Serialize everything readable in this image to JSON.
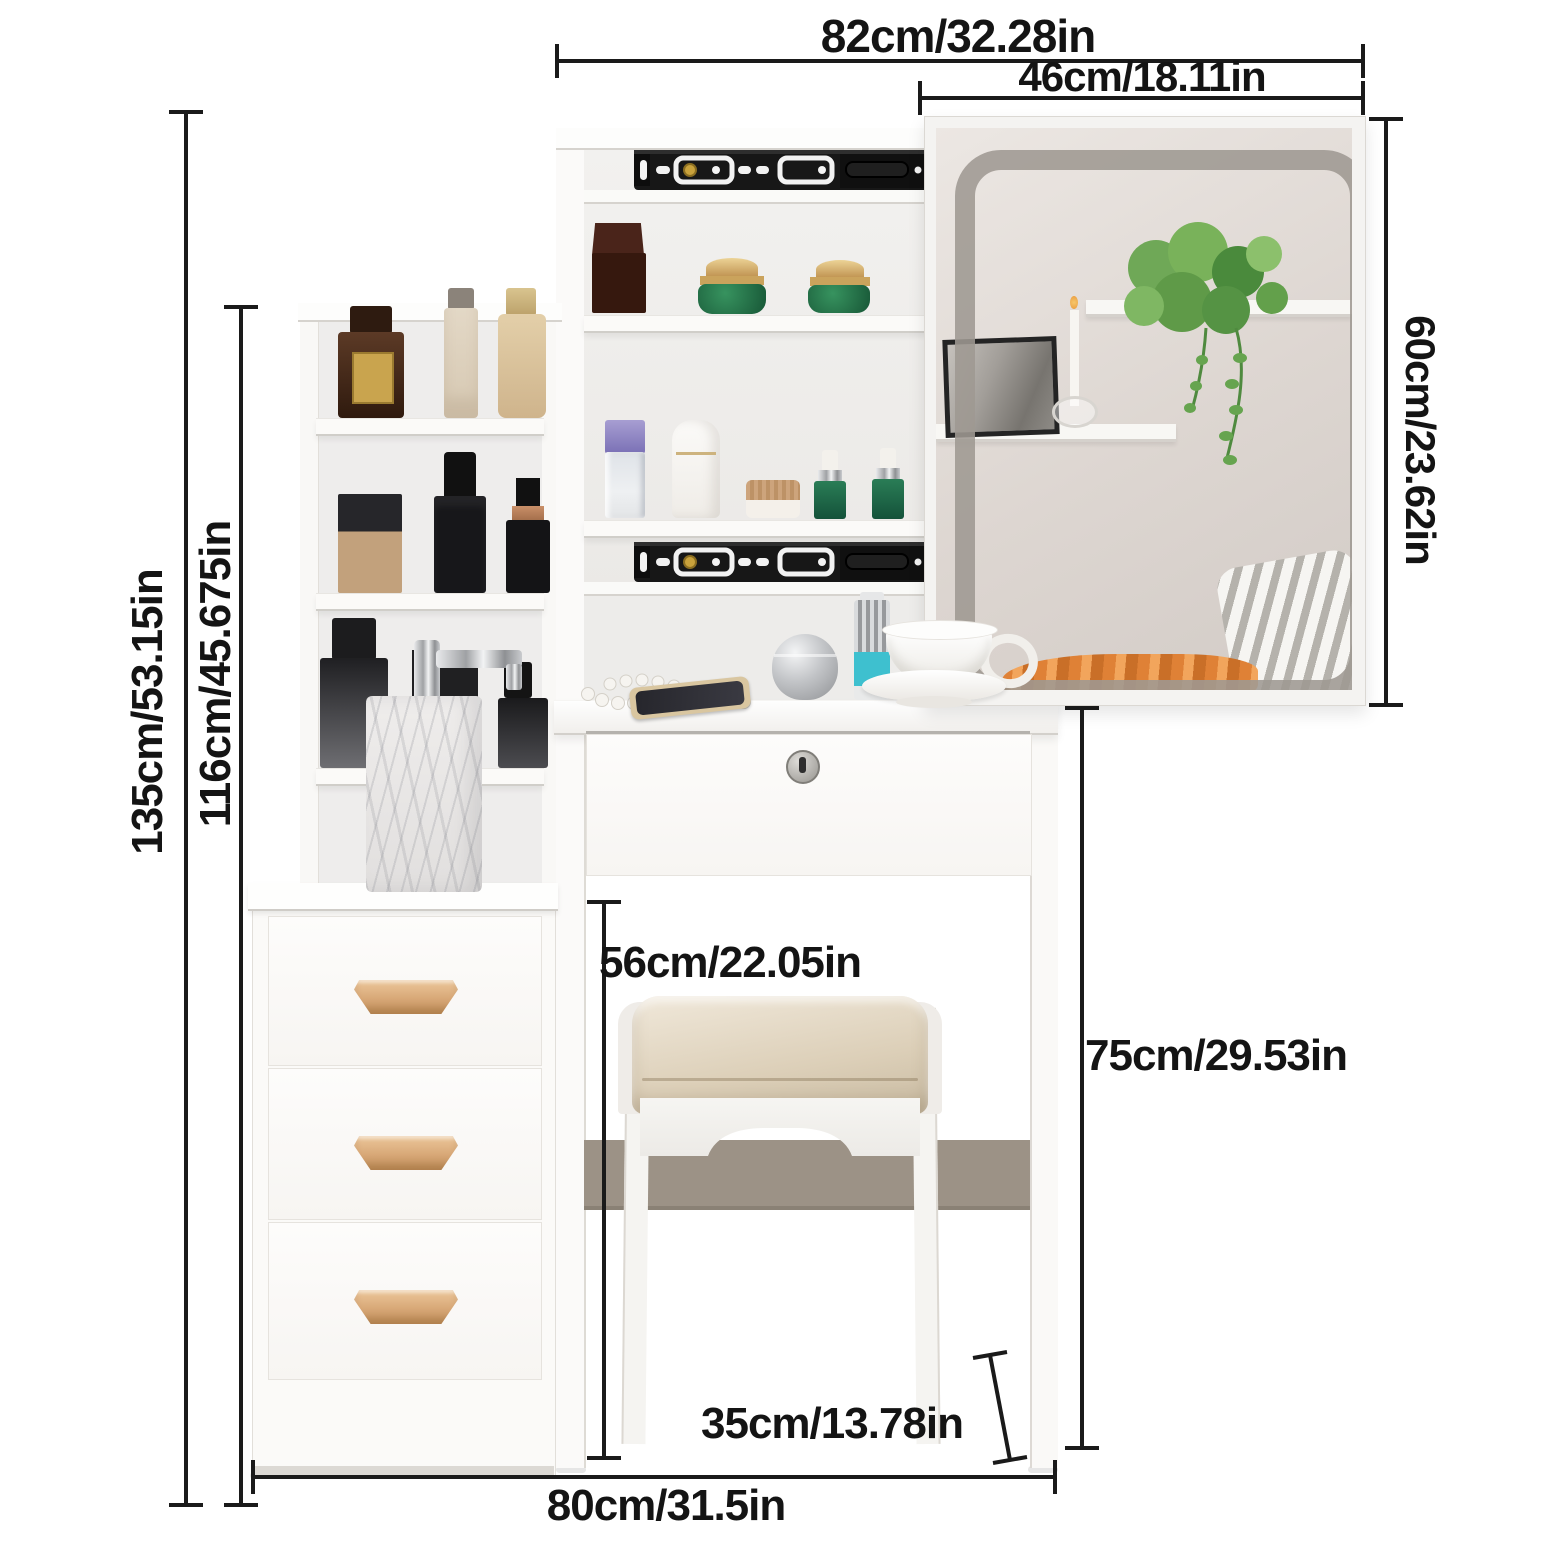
{
  "image_type": "furniture-dimension-diagram",
  "dimensions": {
    "top_width": {
      "label": "82cm/32.28in"
    },
    "mirror_width": {
      "label": "46cm/18.11in"
    },
    "mirror_height": {
      "label": "60cm/23.62in"
    },
    "total_height": {
      "label": "135cm/53.15in"
    },
    "hutch_height": {
      "label": "116cm/45.675in"
    },
    "stool_seat_height": {
      "label": "56cm/22.05in"
    },
    "table_height": {
      "label": "75cm/29.53in"
    },
    "stool_width": {
      "label": "35cm/13.78in"
    },
    "base_width": {
      "label": "80cm/31.5in"
    }
  },
  "colors": {
    "dimension_text": "#141414",
    "dimension_line": "#1a1a1a",
    "furniture_white": "#fbfaf8",
    "wood_handle": "#d8a877",
    "stool_cushion": "#ddd0b8",
    "stretcher": "#9c9286",
    "drawer_rail": "#171717",
    "mirror_led": "#9e9892",
    "cream_jar_green": "#2e8a57",
    "blanket_orange": "#e08b3d"
  }
}
